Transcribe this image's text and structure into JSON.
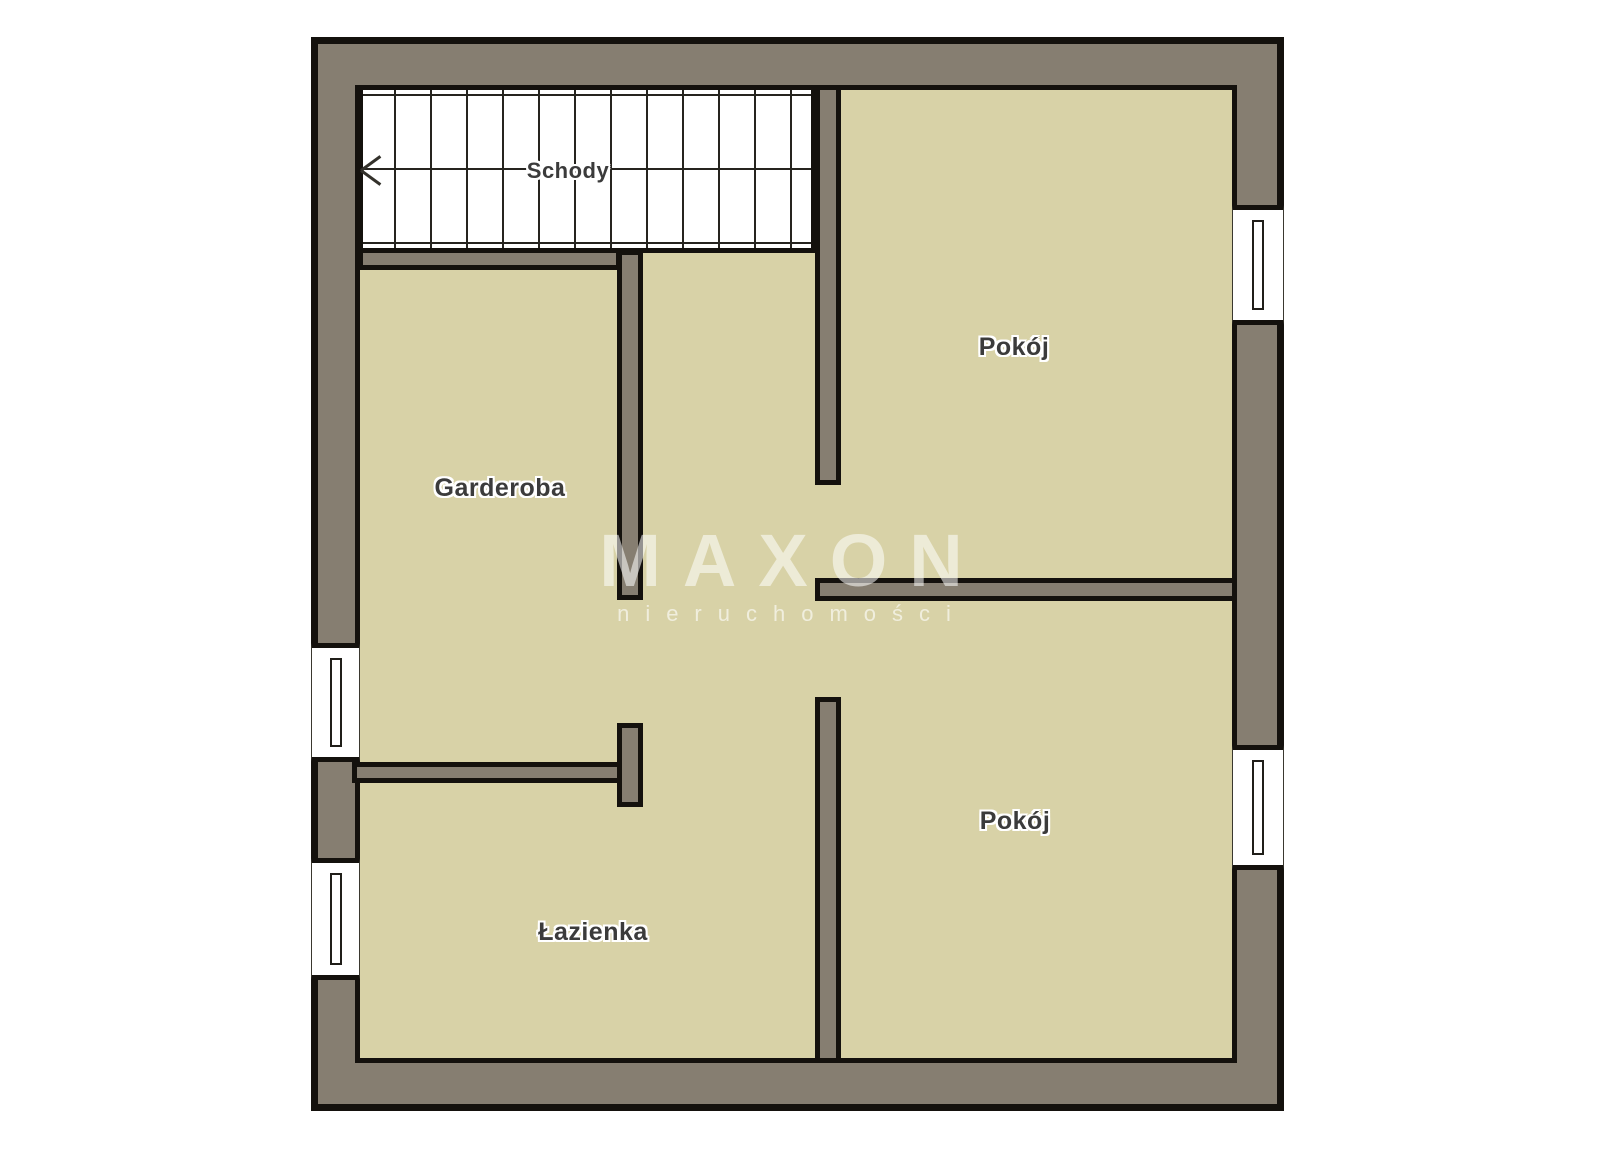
{
  "plan": {
    "type": "floor-plan",
    "rooms": [
      {
        "id": "schody",
        "label": "Schody"
      },
      {
        "id": "garderoba",
        "label": "Garderoba"
      },
      {
        "id": "pokoj-top",
        "label": "Pokój"
      },
      {
        "id": "pokoj-bottom",
        "label": "Pokój"
      },
      {
        "id": "lazienka",
        "label": "Łazienka"
      }
    ],
    "features": {
      "windows": 4,
      "stairs_direction": "left-arrow"
    },
    "watermark": {
      "title": "MAXON",
      "subtitle": "nieruchomości"
    },
    "colors": {
      "wall": "#867e71",
      "outline": "#14110d",
      "floor": "#d8d2a7",
      "stairs": "#ffffff",
      "label_text": "#3b3b3b",
      "watermark": "rgba(255,255,255,0.55)",
      "background": "#ffffff"
    }
  }
}
